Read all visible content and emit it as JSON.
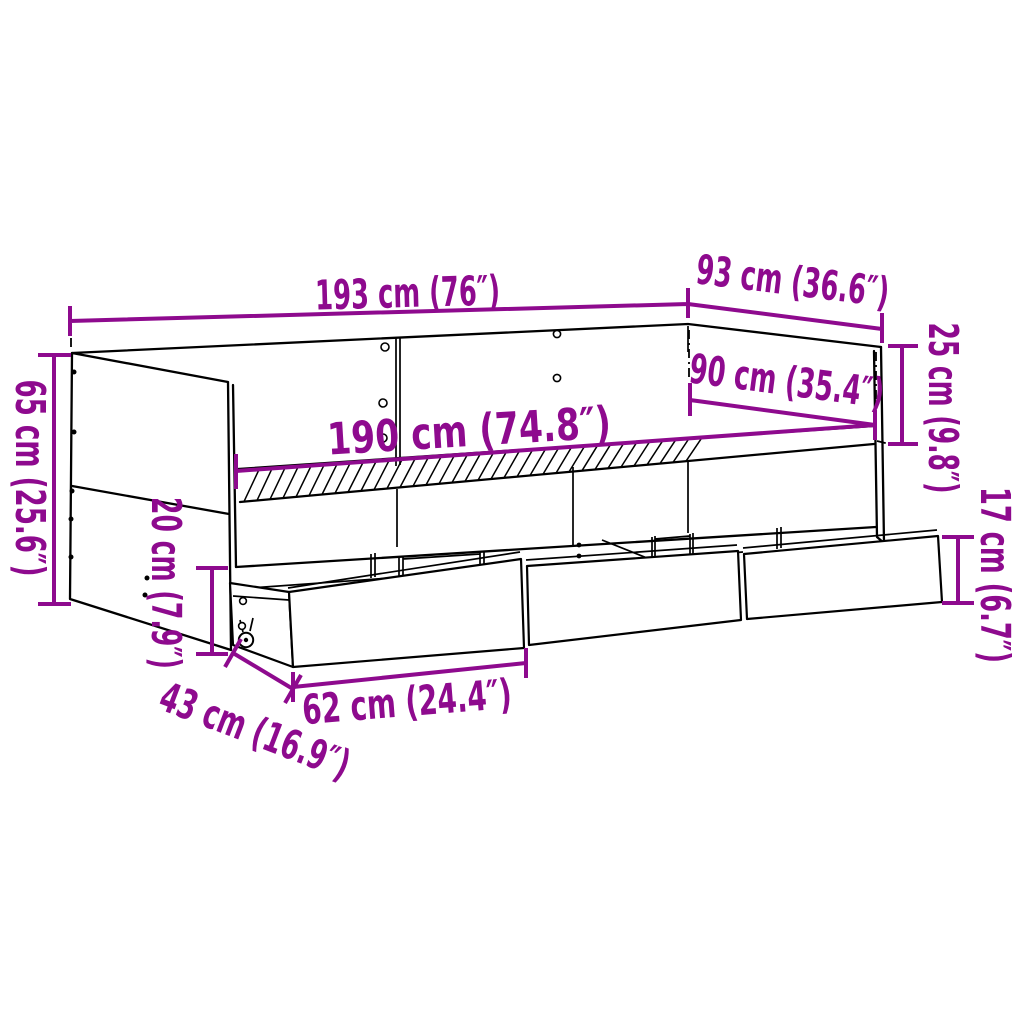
{
  "diagram": {
    "type": "furniture-dimension-diagram",
    "subject": "daybed with storage drawers",
    "background_color": "#FFFFFF",
    "drawing_line_color": "#000000",
    "dimension_color": "#8E0A8E",
    "dimensions": [
      {
        "id": "outer-length",
        "label": "193 cm (76″)"
      },
      {
        "id": "outer-depth",
        "label": "93 cm (36.6″)"
      },
      {
        "id": "backrest-height",
        "label": "25 cm (9.8″)"
      },
      {
        "id": "mattress-width",
        "label": "90 cm (35.4″)"
      },
      {
        "id": "mattress-length",
        "label": "190 cm (74.8″)"
      },
      {
        "id": "total-height",
        "label": "65 cm (25.6″)"
      },
      {
        "id": "base-height",
        "label": "20 cm (7.9″)"
      },
      {
        "id": "drawer-depth",
        "label": "43 cm (16.9″)"
      },
      {
        "id": "drawer-width",
        "label": "62 cm (24.4″)"
      },
      {
        "id": "drawer-height",
        "label": "17 cm (6.7″)"
      }
    ]
  }
}
